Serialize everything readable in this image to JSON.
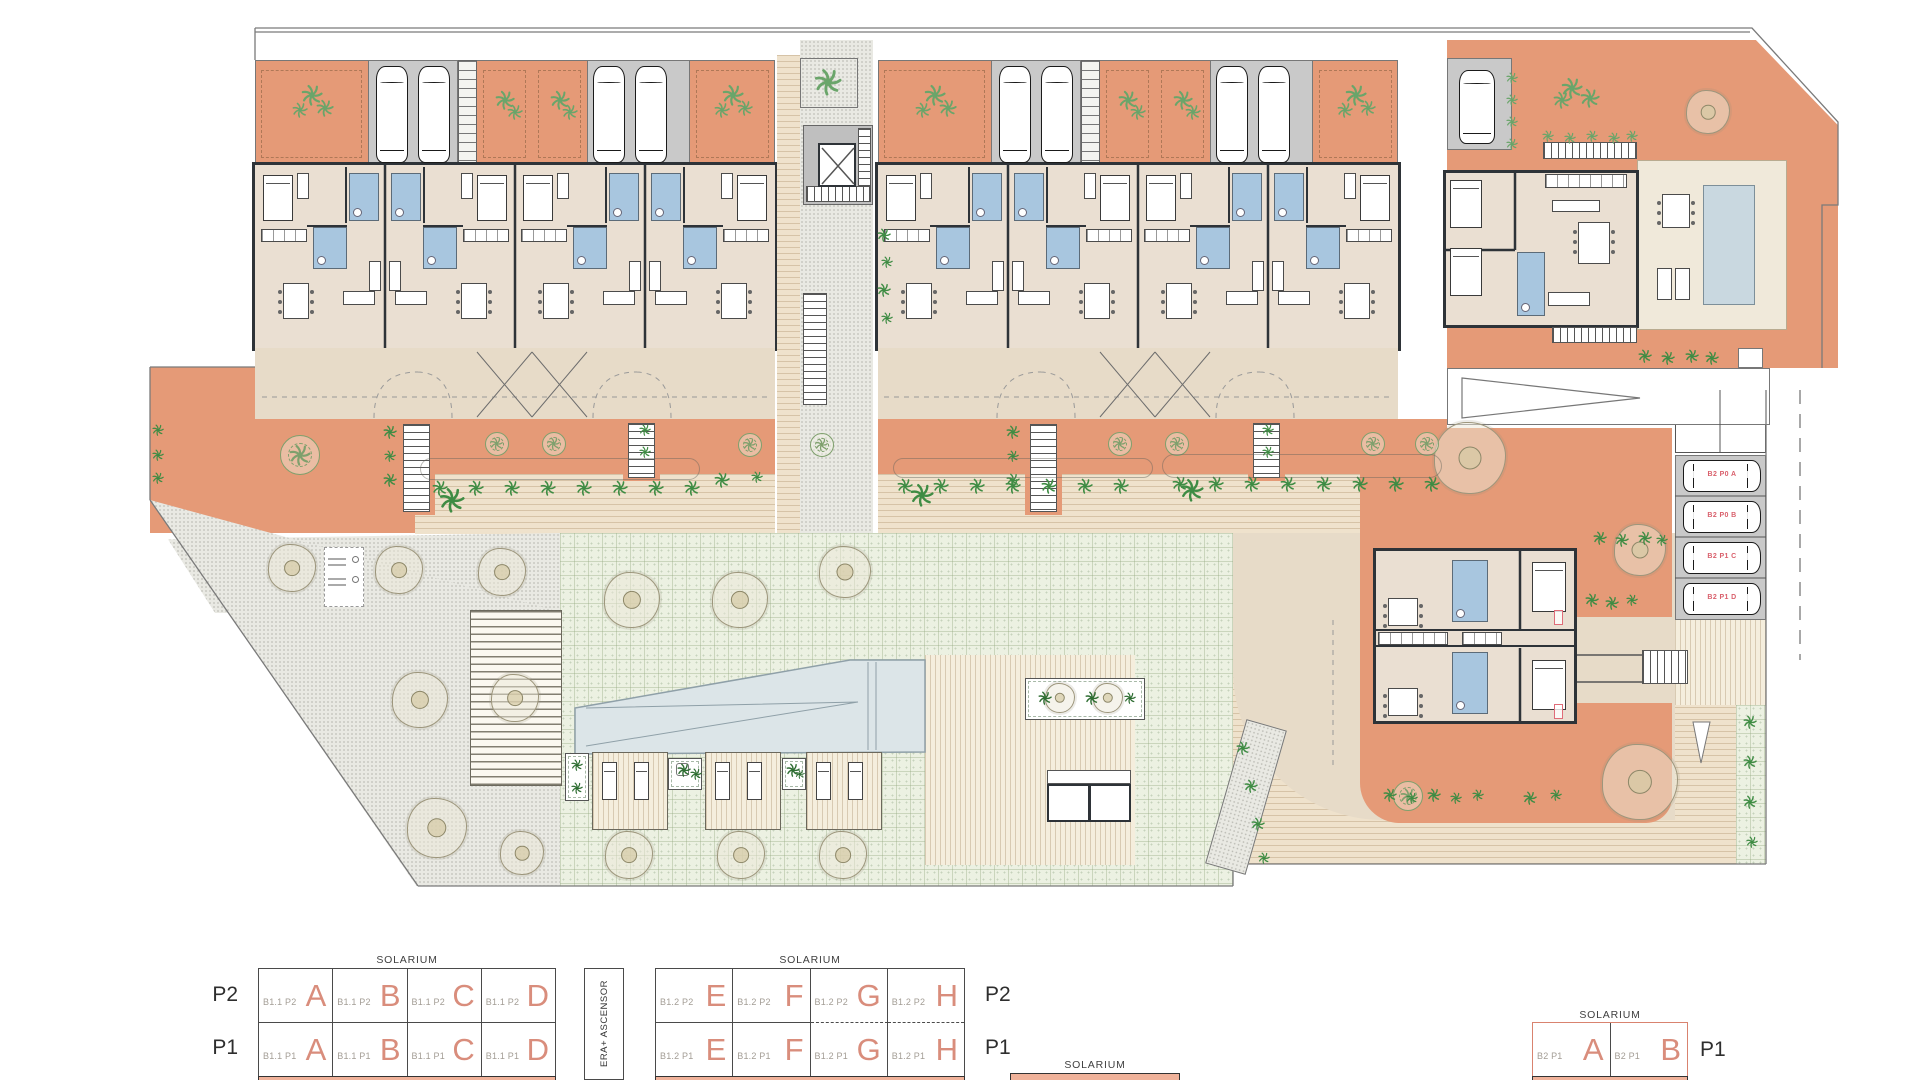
{
  "legend": {
    "blocks": [
      {
        "id": "B1.1",
        "solarium": "SOLARIUM",
        "rows": [
          {
            "level": "P2",
            "cells": [
              {
                "code": "B1.1 P2",
                "letter": "A"
              },
              {
                "code": "B1.1 P2",
                "letter": "B"
              },
              {
                "code": "B1.1 P2",
                "letter": "C"
              },
              {
                "code": "B1.1 P2",
                "letter": "D"
              }
            ]
          },
          {
            "level": "P1",
            "cells": [
              {
                "code": "B1.1 P1",
                "letter": "A"
              },
              {
                "code": "B1.1 P1",
                "letter": "B"
              },
              {
                "code": "B1.1 P1",
                "letter": "C"
              },
              {
                "code": "B1.1 P1",
                "letter": "D"
              }
            ]
          }
        ]
      },
      {
        "id": "B1.2",
        "solarium": "SOLARIUM",
        "rows": [
          {
            "level": "P2",
            "cells": [
              {
                "code": "B1.2 P2",
                "letter": "E"
              },
              {
                "code": "B1.2 P2",
                "letter": "F"
              },
              {
                "code": "B1.2 P2",
                "letter": "G"
              },
              {
                "code": "B1.2 P2",
                "letter": "H"
              }
            ]
          },
          {
            "level": "P1",
            "cells": [
              {
                "code": "B1.2 P1",
                "letter": "E"
              },
              {
                "code": "B1.2 P1",
                "letter": "F"
              },
              {
                "code": "B1.2 P1",
                "letter": "G"
              },
              {
                "code": "B1.2 P1",
                "letter": "H"
              }
            ]
          }
        ]
      },
      {
        "id": "B2",
        "solarium": "SOLARIUM",
        "rows": [
          {
            "level": "P1",
            "cells": [
              {
                "code": "B2 P1",
                "letter": "A"
              },
              {
                "code": "B2 P1",
                "letter": "B"
              }
            ]
          }
        ]
      }
    ],
    "stair_core_label": "ERA+ ASCENSOR",
    "bottom_strip": {
      "solarium": "SOLARIUM"
    }
  },
  "plan": {
    "parking_labels": [
      "B2 P0 A",
      "B2 P0 B",
      "B2 P1 C",
      "B2 P1 D"
    ]
  },
  "colors": {
    "terrace": "#e59a77",
    "walkway": "#efe2cc",
    "lawn": "#ecf1e2",
    "pool": "#dce5e8",
    "accent_letter": "#d98d7c",
    "bar": "#f0b29a",
    "parking_label": "#d9606c"
  }
}
